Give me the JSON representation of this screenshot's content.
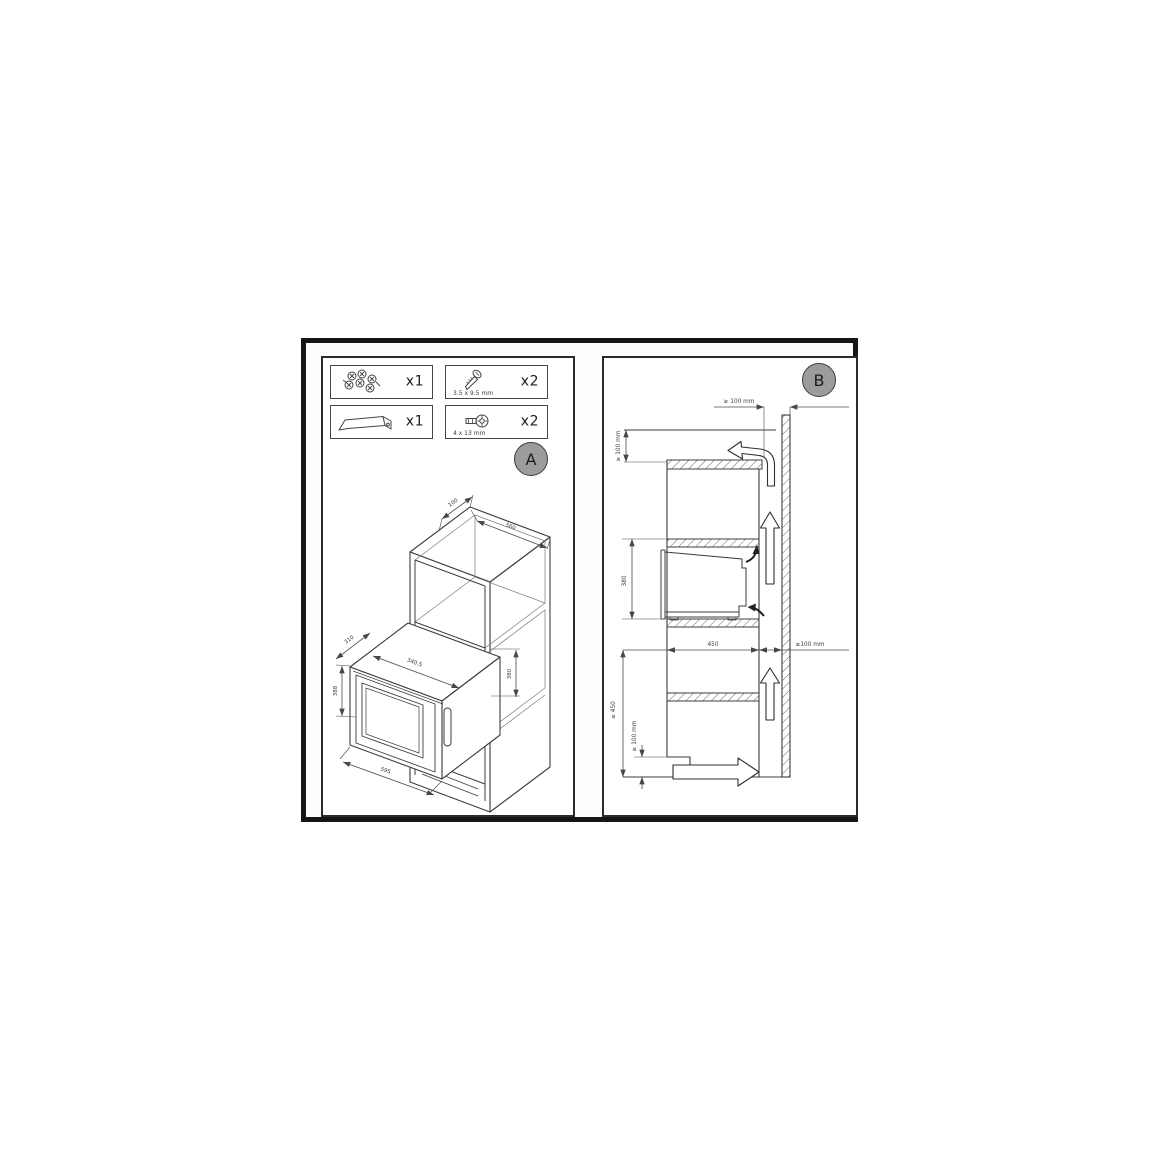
{
  "figure": {
    "panel_a": {
      "badge": "A",
      "parts": [
        {
          "name": "screw-washer-set",
          "qty": "x1"
        },
        {
          "name": "screw-small",
          "qty": "x2",
          "size": "3.5 x 9.5 mm"
        },
        {
          "name": "mounting-bracket",
          "qty": "x1"
        },
        {
          "name": "screw-pan-head",
          "qty": "x2",
          "size": "4 x 13 mm"
        }
      ],
      "dims": {
        "top_depth": "100",
        "niche_width": "560",
        "unit_depth": "310",
        "unit_top_width": "340.5",
        "unit_height": "388",
        "niche_height": "380",
        "unit_width": "595"
      }
    },
    "panel_b": {
      "badge": "B",
      "dims": {
        "top_rear_gap": "≥ 100 mm",
        "top_clearance": "≥ 100 mm",
        "niche_height": "380",
        "niche_depth": "450",
        "rear_gap": "≥100 mm",
        "base_height": "≥ 450",
        "plinth_vent": "≥ 100 mm"
      }
    }
  }
}
